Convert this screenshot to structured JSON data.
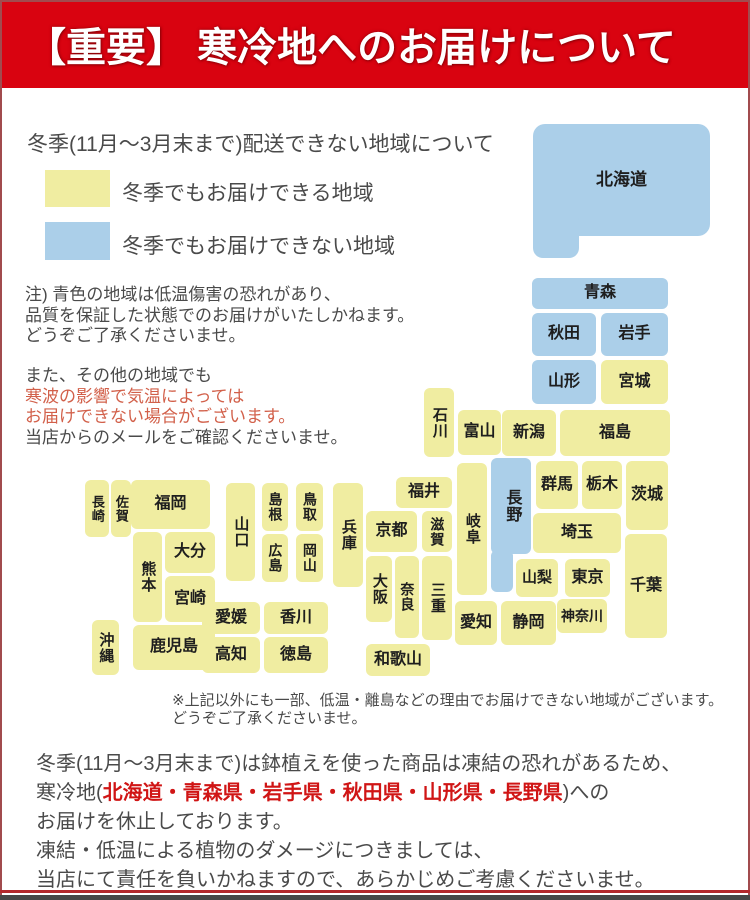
{
  "header": {
    "title": "【重要】 寒冷地へのお届けについて",
    "bg": "#d90310",
    "text_color": "#ffffff"
  },
  "legend": {
    "title": "冬季(11月～3月末まで)配送できない地域について",
    "items": [
      {
        "key": "deliverable",
        "color": "#f0eda1",
        "label": "冬季でもお届けできる地域"
      },
      {
        "key": "not-deliverable",
        "color": "#abcfe9",
        "label": "冬季でもお届けできない地域"
      }
    ]
  },
  "notes": {
    "para1": [
      "注) 青色の地域は低温傷害の恐れがあり、",
      "品質を保証した状態でのお届けがいたしかねます。",
      "どうぞご了承くださいませ。"
    ],
    "para2_line1": "また、その他の地域でも",
    "para2_red1": "寒波の影響で気温によっては",
    "para2_red2": "お届けできない場合がございます。",
    "para2_line4": "当店からのメールをご確認くださいませ。",
    "red_color": "#d2604a"
  },
  "map": {
    "colors": {
      "deliverable": "#f0eda1",
      "not_deliverable": "#abcfe9",
      "label": "#1e1e1e"
    },
    "blocks": [
      {
        "key": "hokkaido",
        "name": "北海道",
        "status": "not_deliverable",
        "fs": 17,
        "parts": [
          {
            "x": 533,
            "y": 124,
            "w": 177,
            "h": 112,
            "r": 12
          },
          {
            "x": 533,
            "y": 210,
            "w": 46,
            "h": 48,
            "r": 10
          }
        ]
      },
      {
        "key": "aomori",
        "name": "青森",
        "status": "not_deliverable",
        "x": 532,
        "y": 278,
        "w": 136,
        "h": 31,
        "fs": 16
      },
      {
        "key": "akita",
        "name": "秋田",
        "status": "not_deliverable",
        "x": 532,
        "y": 313,
        "w": 64,
        "h": 43,
        "fs": 16
      },
      {
        "key": "iwate",
        "name": "岩手",
        "status": "not_deliverable",
        "x": 601,
        "y": 313,
        "w": 67,
        "h": 43,
        "fs": 16
      },
      {
        "key": "yamagata",
        "name": "山形",
        "status": "not_deliverable",
        "x": 532,
        "y": 360,
        "w": 64,
        "h": 44,
        "fs": 16
      },
      {
        "key": "miyagi",
        "name": "宮城",
        "status": "deliverable",
        "x": 601,
        "y": 360,
        "w": 67,
        "h": 44,
        "fs": 16
      },
      {
        "key": "niigata",
        "name": "新潟",
        "status": "deliverable",
        "x": 502,
        "y": 410,
        "w": 54,
        "h": 46,
        "fs": 16
      },
      {
        "key": "fukushima",
        "name": "福島",
        "status": "deliverable",
        "x": 560,
        "y": 410,
        "w": 110,
        "h": 46,
        "fs": 16
      },
      {
        "key": "ishikawa",
        "name": "石川",
        "status": "deliverable",
        "x": 424,
        "y": 388,
        "w": 30,
        "h": 69,
        "vertical": true,
        "fs": 15
      },
      {
        "key": "toyama",
        "name": "富山",
        "status": "deliverable",
        "x": 458,
        "y": 410,
        "w": 43,
        "h": 45,
        "fs": 16
      },
      {
        "key": "gunma",
        "name": "群馬",
        "status": "deliverable",
        "x": 536,
        "y": 461,
        "w": 42,
        "h": 48,
        "fs": 16
      },
      {
        "key": "tochigi",
        "name": "栃木",
        "status": "deliverable",
        "x": 582,
        "y": 461,
        "w": 40,
        "h": 48,
        "fs": 16
      },
      {
        "key": "ibaraki",
        "name": "茨城",
        "status": "deliverable",
        "x": 626,
        "y": 461,
        "w": 42,
        "h": 69,
        "fs": 16
      },
      {
        "key": "nagano",
        "name": "長野",
        "status": "not_deliverable",
        "vertical": true,
        "fs": 16,
        "parts": [
          {
            "x": 491,
            "y": 458,
            "w": 40,
            "h": 96,
            "r": 6
          },
          {
            "x": 491,
            "y": 550,
            "w": 22,
            "h": 42,
            "r": 6
          }
        ]
      },
      {
        "key": "gifu",
        "name": "岐阜",
        "status": "deliverable",
        "x": 457,
        "y": 463,
        "w": 30,
        "h": 132,
        "vertical": true,
        "fs": 15
      },
      {
        "key": "saitama",
        "name": "埼玉",
        "status": "deliverable",
        "x": 533,
        "y": 513,
        "w": 88,
        "h": 40,
        "fs": 16
      },
      {
        "key": "chiba",
        "name": "千葉",
        "status": "deliverable",
        "x": 625,
        "y": 534,
        "w": 42,
        "h": 104,
        "fs": 16
      },
      {
        "key": "yamanashi",
        "name": "山梨",
        "status": "deliverable",
        "x": 516,
        "y": 559,
        "w": 42,
        "h": 38,
        "fs": 15
      },
      {
        "key": "tokyo",
        "name": "東京",
        "status": "deliverable",
        "x": 565,
        "y": 559,
        "w": 45,
        "h": 38,
        "fs": 16
      },
      {
        "key": "kanagawa",
        "name": "神奈川",
        "status": "deliverable",
        "x": 557,
        "y": 599,
        "w": 50,
        "h": 34,
        "fs": 14
      },
      {
        "key": "shizuoka",
        "name": "静岡",
        "status": "deliverable",
        "x": 501,
        "y": 601,
        "w": 55,
        "h": 44,
        "fs": 16
      },
      {
        "key": "aichi",
        "name": "愛知",
        "status": "deliverable",
        "x": 455,
        "y": 601,
        "w": 42,
        "h": 44,
        "fs": 16
      },
      {
        "key": "fukui",
        "name": "福井",
        "status": "deliverable",
        "x": 396,
        "y": 477,
        "w": 56,
        "h": 31,
        "fs": 16
      },
      {
        "key": "kyoto",
        "name": "京都",
        "status": "deliverable",
        "x": 366,
        "y": 511,
        "w": 51,
        "h": 41,
        "fs": 16
      },
      {
        "key": "shiga",
        "name": "滋賀",
        "status": "deliverable",
        "x": 422,
        "y": 511,
        "w": 30,
        "h": 41,
        "vertical": true,
        "fs": 14
      },
      {
        "key": "mie",
        "name": "三重",
        "status": "deliverable",
        "x": 422,
        "y": 556,
        "w": 30,
        "h": 84,
        "vertical": true,
        "fs": 15
      },
      {
        "key": "nara",
        "name": "奈良",
        "status": "deliverable",
        "x": 395,
        "y": 556,
        "w": 24,
        "h": 82,
        "vertical": true,
        "fs": 14
      },
      {
        "key": "osaka",
        "name": "大阪",
        "status": "deliverable",
        "x": 366,
        "y": 556,
        "w": 26,
        "h": 66,
        "vertical": true,
        "fs": 15
      },
      {
        "key": "wakayama",
        "name": "和歌山",
        "status": "deliverable",
        "x": 366,
        "y": 644,
        "w": 64,
        "h": 32,
        "fs": 16
      },
      {
        "key": "hyogo",
        "name": "兵庫",
        "status": "deliverable",
        "x": 333,
        "y": 483,
        "w": 30,
        "h": 104,
        "vertical": true,
        "fs": 15
      },
      {
        "key": "tottori",
        "name": "鳥取",
        "status": "deliverable",
        "x": 296,
        "y": 483,
        "w": 27,
        "h": 48,
        "vertical": true,
        "fs": 14
      },
      {
        "key": "shimane",
        "name": "島根",
        "status": "deliverable",
        "x": 262,
        "y": 483,
        "w": 26,
        "h": 48,
        "vertical": true,
        "fs": 14
      },
      {
        "key": "okayama",
        "name": "岡山",
        "status": "deliverable",
        "x": 296,
        "y": 534,
        "w": 27,
        "h": 48,
        "vertical": true,
        "fs": 14
      },
      {
        "key": "hiroshima",
        "name": "広島",
        "status": "deliverable",
        "x": 262,
        "y": 534,
        "w": 26,
        "h": 48,
        "vertical": true,
        "fs": 14
      },
      {
        "key": "yamaguchi",
        "name": "山口",
        "status": "deliverable",
        "x": 226,
        "y": 483,
        "w": 29,
        "h": 98,
        "vertical": true,
        "fs": 15
      },
      {
        "key": "ehime",
        "name": "愛媛",
        "status": "deliverable",
        "x": 202,
        "y": 602,
        "w": 58,
        "h": 32,
        "fs": 16
      },
      {
        "key": "kagawa",
        "name": "香川",
        "status": "deliverable",
        "x": 264,
        "y": 602,
        "w": 64,
        "h": 32,
        "fs": 16
      },
      {
        "key": "kochi",
        "name": "高知",
        "status": "deliverable",
        "x": 202,
        "y": 637,
        "w": 58,
        "h": 36,
        "fs": 16
      },
      {
        "key": "tokushima",
        "name": "徳島",
        "status": "deliverable",
        "x": 264,
        "y": 637,
        "w": 64,
        "h": 36,
        "fs": 16
      },
      {
        "key": "fukuoka",
        "name": "福岡",
        "status": "deliverable",
        "x": 131,
        "y": 480,
        "w": 79,
        "h": 49,
        "fs": 16
      },
      {
        "key": "saga",
        "name": "佐賀",
        "status": "deliverable",
        "x": 111,
        "y": 480,
        "w": 20,
        "h": 57,
        "vertical": true,
        "fs": 13
      },
      {
        "key": "nagasaki",
        "name": "長崎",
        "status": "deliverable",
        "x": 85,
        "y": 480,
        "w": 24,
        "h": 57,
        "vertical": true,
        "fs": 13
      },
      {
        "key": "kumamoto",
        "name": "熊本",
        "status": "deliverable",
        "x": 133,
        "y": 532,
        "w": 29,
        "h": 90,
        "vertical": true,
        "fs": 15
      },
      {
        "key": "oita",
        "name": "大分",
        "status": "deliverable",
        "x": 165,
        "y": 532,
        "w": 50,
        "h": 41,
        "fs": 16
      },
      {
        "key": "miyazaki",
        "name": "宮崎",
        "status": "deliverable",
        "x": 165,
        "y": 576,
        "w": 50,
        "h": 46,
        "fs": 16
      },
      {
        "key": "kagoshima",
        "name": "鹿児島",
        "status": "deliverable",
        "x": 133,
        "y": 625,
        "w": 82,
        "h": 45,
        "fs": 16
      },
      {
        "key": "okinawa",
        "name": "沖縄",
        "status": "deliverable",
        "x": 92,
        "y": 620,
        "w": 27,
        "h": 55,
        "vertical": true,
        "fs": 15
      }
    ]
  },
  "map_note": [
    "※上記以外にも一部、低温・離島などの理由でお届けできない地域がございます。",
    "どうぞご了承くださいませ。"
  ],
  "footer": {
    "line1": "冬季(11月～3月末まで)は鉢植えを使った商品は凍結の恐れがあるため、",
    "line2_pre": "寒冷地(",
    "line2_red": "北海道・青森県・岩手県・秋田県・山形県・長野県",
    "line2_post": ")への",
    "line3": "お届けを休止しております。",
    "line4": "凍結・低温による植物のダメージにつきましては、",
    "line5": "当店にて責任を負いかねますので、あらかじめご考慮くださいませ。",
    "red_color": "#d01515"
  }
}
